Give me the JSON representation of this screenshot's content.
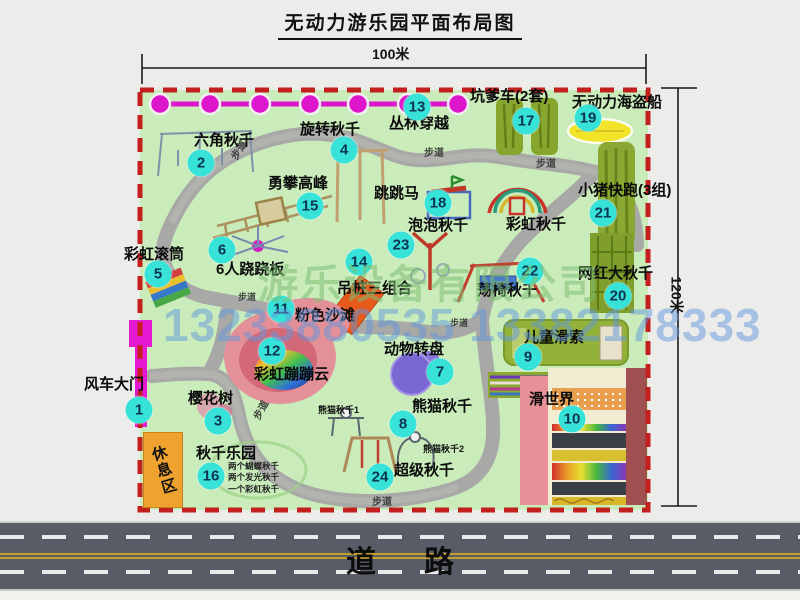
{
  "title": "无动力游乐园平面布局图",
  "dimensions": {
    "top": "100米",
    "right": "120米"
  },
  "walkway_label": "步道",
  "rest_area_label": "休息区",
  "road_label": "道路",
  "watermark": {
    "company": "游乐设备有限公司",
    "phone": "13233880535 13382178333"
  },
  "attractions": {
    "gate": {
      "num": "1",
      "label": "风车大门"
    },
    "hexagon_swing": {
      "num": "2",
      "label": "六角秋千"
    },
    "cherry_tree": {
      "num": "3",
      "label": "樱花树"
    },
    "rotating_swing": {
      "num": "4",
      "label": "旋转秋千"
    },
    "rainbow_roller": {
      "num": "5",
      "label": "彩虹滚筒"
    },
    "seesaw_6p": {
      "num": "6",
      "label": "6人跷跷板"
    },
    "animal_carousel": {
      "num": "7",
      "label": "动物转盘"
    },
    "panda_swing": {
      "num": "8",
      "label": "熊猫秋千",
      "sub1": "熊猫秋千1",
      "sub2": "熊猫秋千2"
    },
    "kids_zipline": {
      "num": "9",
      "label": "儿童滑索"
    },
    "slide_world": {
      "num": "10",
      "label": "滑世界"
    },
    "pink_beach": {
      "num": "11",
      "label": "粉色沙滩"
    },
    "rainbow_cloud": {
      "num": "12",
      "label": "彩虹蹦蹦云"
    },
    "jungle_crossing": {
      "num": "13",
      "label": "丛林穿越"
    },
    "hanging_piles": {
      "num": "14",
      "label": "吊桩三组合"
    },
    "climbing_peak": {
      "num": "15",
      "label": "勇攀高峰"
    },
    "swing_park": {
      "num": "16",
      "label": "秋千乐园",
      "subs": [
        "两个蝴蝶秋千",
        "两个发光秋千",
        "一个彩虹秋千"
      ]
    },
    "pit_car": {
      "num": "17",
      "label": "坑爹车(2套)"
    },
    "jumping_horse": {
      "num": "18",
      "label": "跳跳马"
    },
    "pirate_ship": {
      "num": "19",
      "label": "无动力海盗船"
    },
    "big_swing": {
      "num": "20",
      "label": "网红大秋千"
    },
    "piggy_run": {
      "num": "21",
      "label": "小猪快跑(3组)"
    },
    "chair_swing": {
      "num": "22",
      "label": "荡椅秋千"
    },
    "bubble_swing": {
      "num": "23",
      "label": "泡泡秋千"
    },
    "super_swing": {
      "num": "24",
      "label": "超级秋千"
    },
    "rainbow_swing": {
      "label": "彩虹秋千"
    }
  },
  "colors": {
    "park_fill": "#c9ecba",
    "border_red": "#c41f1f",
    "path_gray": "#a8a8a6",
    "badge_teal": "#37e2d8",
    "magenta": "#dd17cc",
    "olive": "#8aa832",
    "pirate_yellow": "#f2e428",
    "rest_orange": "#efa22e",
    "road_gray": "#585c66"
  }
}
